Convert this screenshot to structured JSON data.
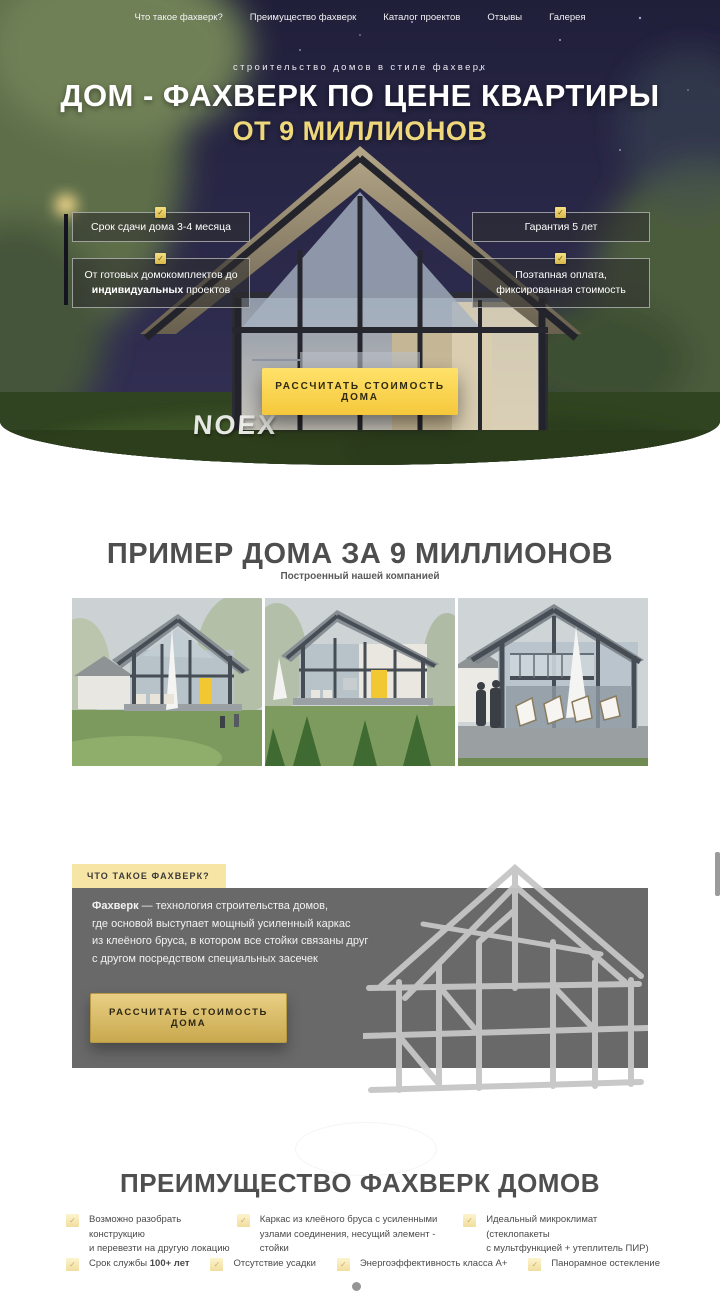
{
  "colors": {
    "accent_yellow": "#f6cf3f",
    "gold_heading": "#eed87b",
    "pale_yellow_tab": "#f7e5a5",
    "dark_section_gray": "#696969",
    "night_sky": "#262544"
  },
  "icons": {
    "check": "✓"
  },
  "nav": {
    "items": [
      {
        "label": "Что такое фахверк?"
      },
      {
        "label": "Преимущество фахверк"
      },
      {
        "label": "Каталог проектов"
      },
      {
        "label": "Отзывы"
      },
      {
        "label": "Галерея"
      }
    ]
  },
  "hero": {
    "tagline": "строительство домов в стиле фахверк",
    "title": "ДОМ - ФАХВЕРК ПО ЦЕНЕ КВАРТИРЫ",
    "price_line": "ОТ 9 МИЛЛИОНОВ",
    "badge_delivery": "Срок сдачи дома 3-4 месяца",
    "badge_warranty": "Гарантия 5 лет",
    "badge_projects_pre": "От готовых домокомплектов до",
    "badge_projects_bold": "индивидуальных",
    "badge_projects_post": " проектов",
    "badge_payment": "Поэтапная оплата,\nфиксированная стоимость",
    "cta_label": "РАССЧИТАТЬ СТОИМОСТЬ ДОМА",
    "sign_text": "NOEX"
  },
  "example": {
    "title": "ПРИМЕР ДОМА ЗА 9 МИЛЛИОНОВ",
    "subtitle": "Построенный нашей компанией"
  },
  "about": {
    "tab_label": "ЧТО ТАКОЕ ФАХВЕРК?",
    "term": "Фахверк",
    "description": " — технология строительства домов,\nгде основой выступает мощный усиленный каркас\nиз клеёного бруса, в котором все стойки связаны друг\nс другом посредством специальных засечек",
    "cta_label": "РАССЧИТАТЬ СТОИМОСТЬ ДОМА"
  },
  "advantages": {
    "title": "ПРЕИМУЩЕСТВО ФАХВЕРК ДОМОВ",
    "row1": [
      {
        "text": "Возможно разобрать конструкцию\nи перевезти на другую локацию"
      },
      {
        "text": "Каркас из клеёного бруса с усиленными\nузлами соединения, несущий элемент - стойки"
      },
      {
        "text": "Идеальный микроклимат (стеклопакеты\nс мультфункцией + утеплитель ПИР)"
      }
    ],
    "row2_service_pre": "Срок службы ",
    "row2_service_bold": "100+ лет",
    "row2": [
      {
        "text": "Отсутствие усадки"
      },
      {
        "text": "Энергоэффективность класса А+"
      },
      {
        "text": "Панорамное остекление"
      }
    ]
  }
}
